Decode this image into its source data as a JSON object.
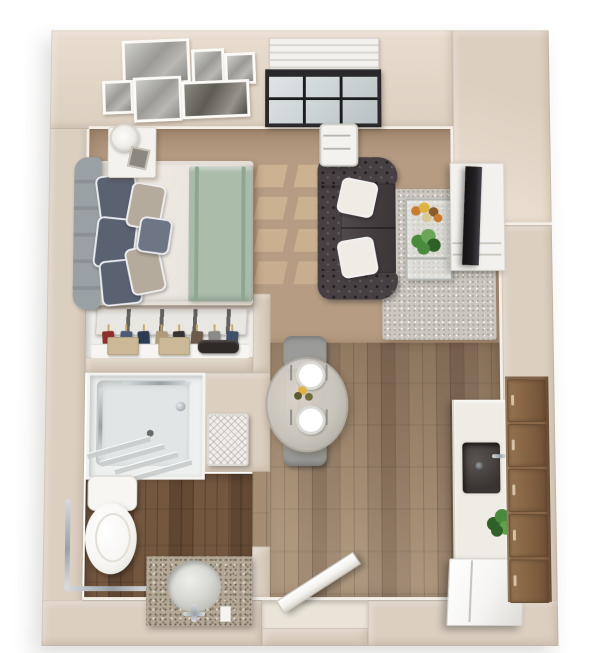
{
  "title": "Studio apartment 3D floor plan",
  "unit": {
    "kind": "studio-apartment",
    "render": "3d-top-down-floor-plan"
  },
  "palette": {
    "wall": "#dbcfc0",
    "wallLight": "#e9ddcf",
    "wallDark": "#c9b9a6",
    "baseboard": "#f4efe7",
    "carpet": "#b59c83",
    "sunPatch": "#ecd2a4",
    "woodLight": "#a48d73",
    "woodMid": "#97806a",
    "woodDark": "#88715b",
    "bathWood": "#74573f",
    "bathWoodDark": "#5f4632",
    "rug": "#cbc7c0",
    "rugDot": "#aca69b",
    "sofa": "#474043",
    "pillowWhite": "#efece6",
    "bedDuvet": "#eae6df",
    "bedFrame": "#e3ded6",
    "bedThrow": "#abbcab",
    "throwStripe": "#8da68f",
    "pillowDark": "#5a6170",
    "pillowBeige": "#b4ab9c",
    "pillowSlate": "#6e7685",
    "headboard": "#9aa1a5",
    "nightstand": "#f4f2ee",
    "frameWhite": "#fbfaf7",
    "windowFrame": "#29282a",
    "windowGlass": "#ccd4d6",
    "blind": "#f2f1ee",
    "closetWhite": "#f1efeb",
    "closetDoor": "#e9e7e2",
    "hanger": "#c9a86a",
    "boxBeige": "#cbb896",
    "bagDark": "#2f2a28",
    "shower": "#e0e6e5",
    "showerPan": "#eef0ef",
    "toilet": "#f7f6f3",
    "granite": "#b3a896",
    "graniteDot": "#8a7f6c",
    "sinkCeramic": "#d8d8d3",
    "basket": "#f0edea",
    "counter": "#efece5",
    "sinkBasin": "#3a3433",
    "fridge": "#f5f4f2",
    "cabinet": "#8a6848",
    "cabinetDark": "#6b4f35",
    "handle": "#d6c3a6",
    "tv": "#232022",
    "console": "#f2f1ed",
    "tableGlass": "#c9c4bc",
    "chair": "#9b9b99",
    "plate": "#ffffff",
    "plateRing": "#d9d9d5",
    "flowerOrange": "#c97b2e",
    "flowerYellow": "#dfb343",
    "plantGreen": "#4a8a3c",
    "plantDark": "#2f6027",
    "door": "#f4f2ee",
    "threshold": "#eae3d7"
  },
  "areas": [
    {
      "name": "sleeping-area",
      "furniture": [
        "upholstered-bed",
        "headboard",
        "nightstand",
        "table-lamp",
        "gallery-wall"
      ]
    },
    {
      "name": "living-area",
      "furniture": [
        "chesterfield-sofa",
        "floor-lamp",
        "coffee-table",
        "area-rug",
        "tv-stand",
        "flat-screen-tv"
      ]
    },
    {
      "name": "dining-area",
      "furniture": [
        "round-glass-table",
        "dining-chairs",
        "place-settings"
      ]
    },
    {
      "name": "kitchen",
      "furniture": [
        "counter-with-sink",
        "faucet",
        "refrigerator",
        "wood-cabinets",
        "potted-plant"
      ]
    },
    {
      "name": "closet",
      "furniture": [
        "sliding-doors",
        "hanging-clothes",
        "storage-boxes",
        "bag"
      ]
    },
    {
      "name": "bathroom",
      "furniture": [
        "roll-in-shower",
        "shower-glass-screen",
        "grab-bars",
        "toilet",
        "granite-vanity-sink",
        "towel-basket"
      ]
    },
    {
      "name": "entry",
      "furniture": [
        "entry-door",
        "threshold"
      ]
    }
  ],
  "gallery_wall": {
    "frames": [
      {
        "x": 116,
        "y": 16,
        "w": 64,
        "h": 42,
        "tone": "light"
      },
      {
        "x": 188,
        "y": 26,
        "w": 28,
        "h": 34,
        "tone": "light"
      },
      {
        "x": 222,
        "y": 30,
        "w": 26,
        "h": 28,
        "tone": "light"
      },
      {
        "x": 96,
        "y": 60,
        "w": 26,
        "h": 30,
        "tone": "light"
      },
      {
        "x": 128,
        "y": 56,
        "w": 44,
        "h": 42,
        "tone": "light"
      },
      {
        "x": 178,
        "y": 60,
        "w": 64,
        "h": 34,
        "tone": "dark"
      }
    ]
  },
  "window": {
    "pane_columns": 3,
    "pane_rows": 2,
    "has_blinds": true
  },
  "closet": {
    "clothes_colors": [
      "#8a2f2b",
      "#4a5a78",
      "#2e3b55",
      "#b09a78",
      "#343434",
      "#6a5a48",
      "#8a8a88",
      "#41506b"
    ],
    "boxes": 2,
    "bags": 1
  },
  "kitchen": {
    "cabinet_doors": 5
  },
  "dining": {
    "seats": 2,
    "place_settings": 2
  },
  "bedroom": {
    "pillows": 6
  }
}
